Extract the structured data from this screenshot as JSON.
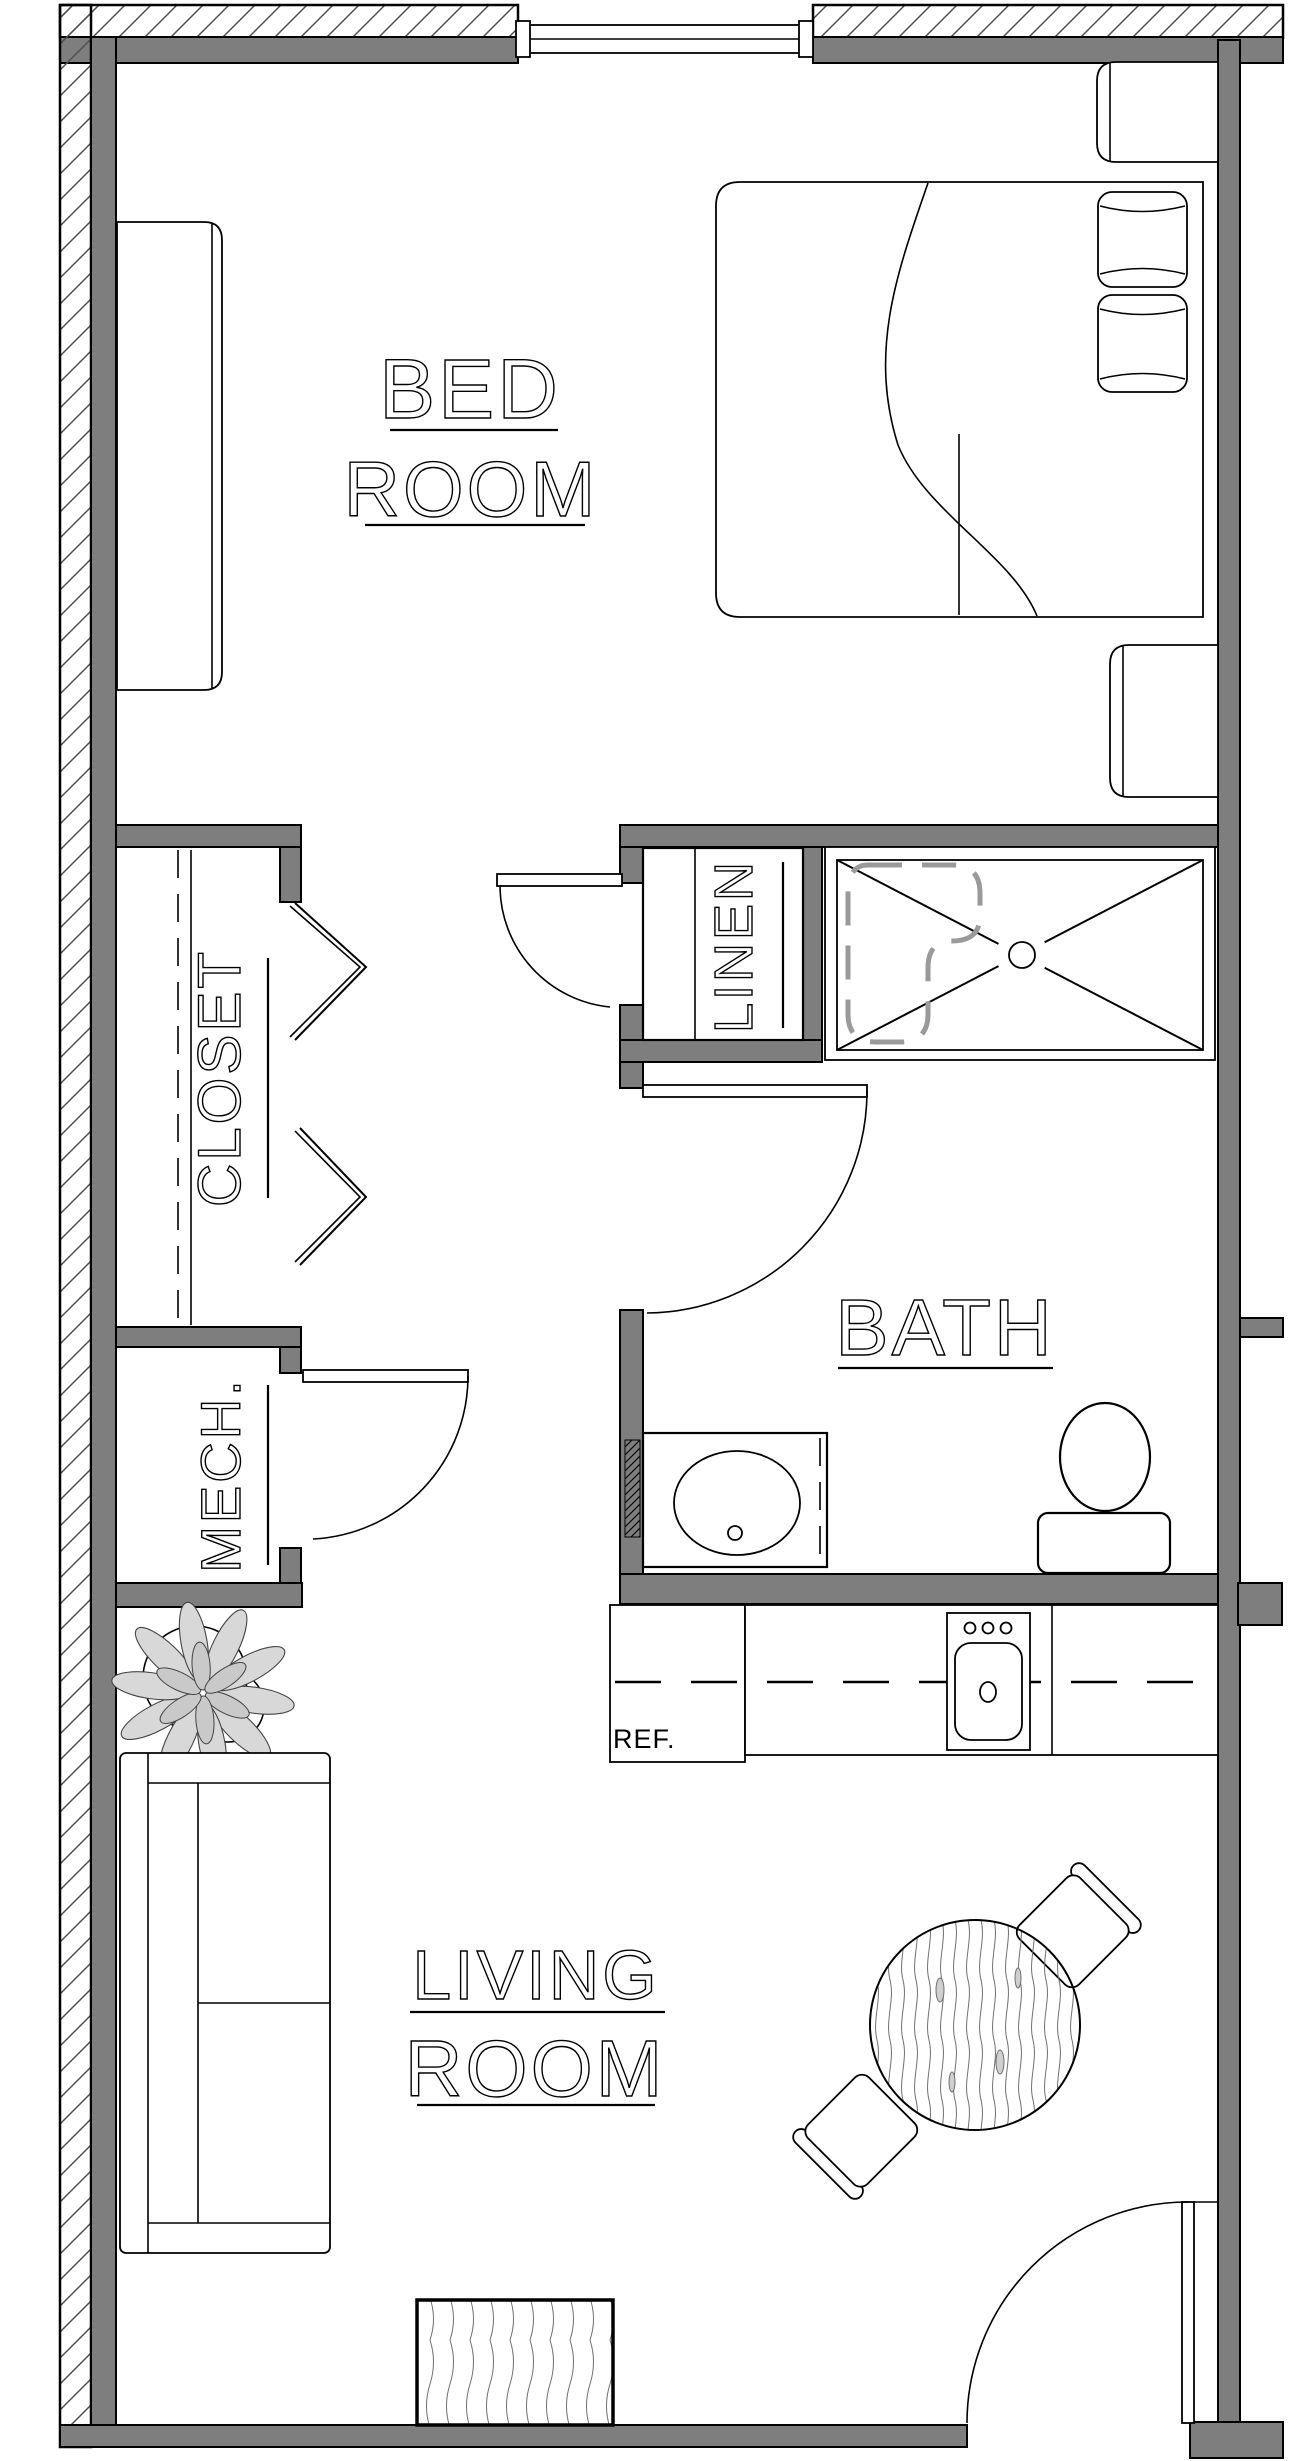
{
  "rooms": {
    "bedroom": {
      "line1": "BED",
      "line2": "ROOM"
    },
    "closet": {
      "label": "CLOSET"
    },
    "linen": {
      "label": "LINEN"
    },
    "bath": {
      "label": "BATH"
    },
    "mech": {
      "label": "MECH."
    },
    "kitchen": {
      "ref_label": "REF."
    },
    "living": {
      "line1": "LIVING",
      "line2": "ROOM"
    }
  },
  "colors": {
    "wall": "#7e7e7e",
    "ink": "#000000",
    "hatch": "#4f4f4f",
    "pan": "#9a9a9a",
    "grain": "#6f6f6f",
    "petal": "#d8d8d8"
  },
  "fixtures": [
    "bed",
    "pillow",
    "nightstand",
    "dresser",
    "window",
    "closet-bifold-doors",
    "closet-rod",
    "closet-shelf",
    "linen-shelves",
    "shower",
    "shower-drain",
    "hall-door",
    "bath-door",
    "mech-door",
    "vanity-sink",
    "toilet",
    "refrigerator",
    "kitchen-counter",
    "kitchen-sink",
    "sofa",
    "plant",
    "dining-table",
    "dining-chair",
    "entry-door",
    "entry-mat"
  ]
}
